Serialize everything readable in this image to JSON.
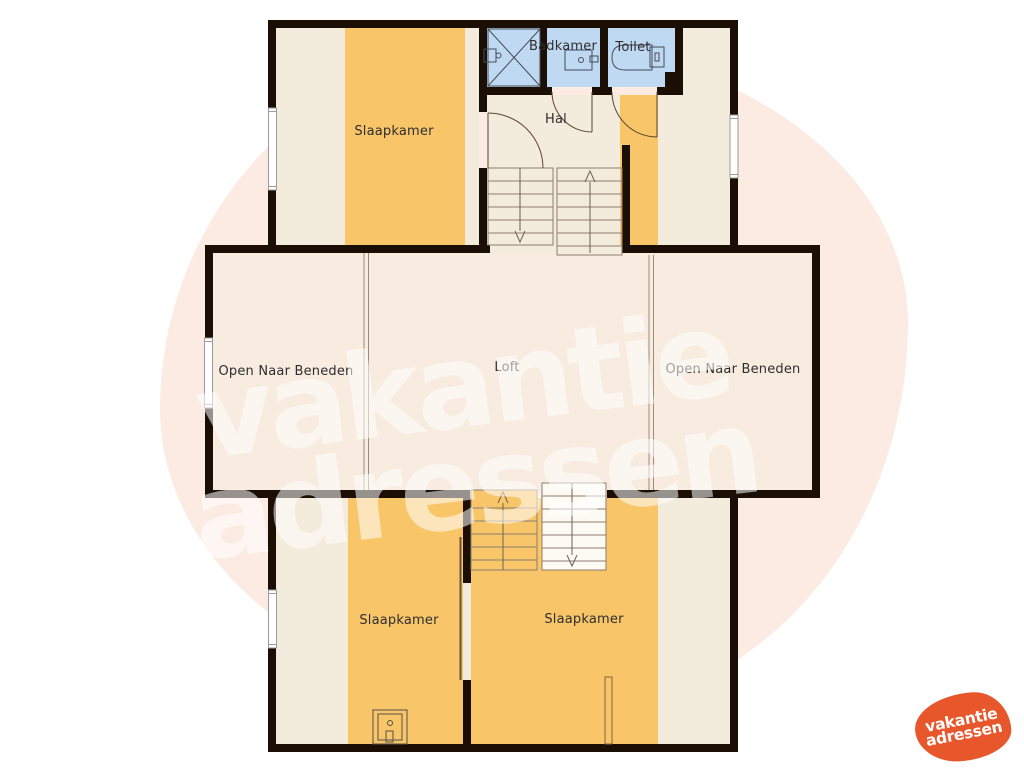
{
  "palette": {
    "wall": "#1b0e05",
    "floor": "#f3ebdc",
    "floor_loft": "#f8ece1",
    "carpet": "#f8c569",
    "wet_room": "#c0d9f2",
    "line": "#8c7e6e",
    "watermark_blob": "#fcebe2",
    "logo_orange": "#e8572b"
  },
  "rooms": {
    "bedroom_top": "Slaapkamer",
    "bathroom": "Badkamer",
    "toilet": "Toilet",
    "hall": "Hal",
    "void_left": "Open Naar Beneden",
    "loft": "Loft",
    "void_right": "Open Naar Beneden",
    "bedroom_bottom_left": "Slaapkamer",
    "bedroom_bottom_right": "Slaapkamer"
  },
  "watermark": {
    "line1": "vakantie",
    "line2": "adressen"
  },
  "logo": {
    "line1": "vakantie",
    "line2": "adressen"
  }
}
